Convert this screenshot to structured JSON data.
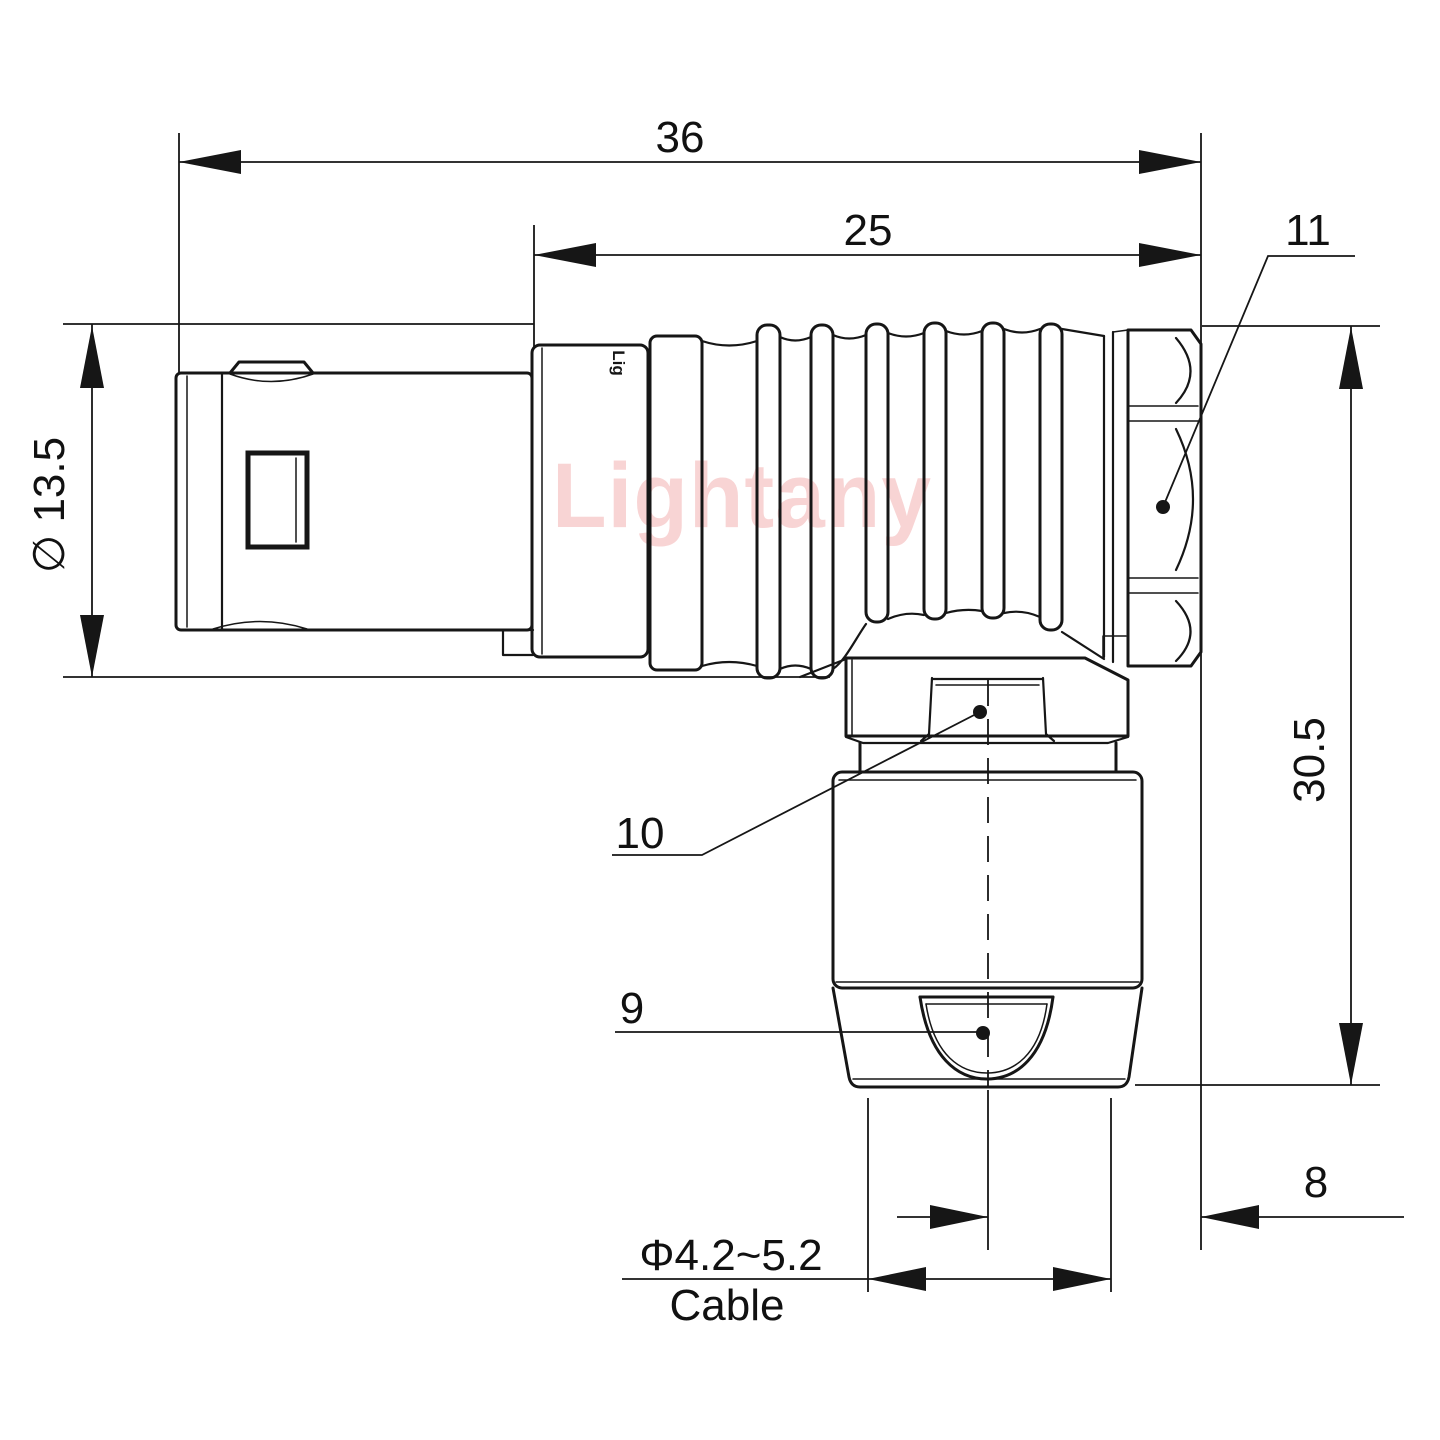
{
  "watermark": {
    "text": "Lightany"
  },
  "part_marking": "Lig",
  "dims": {
    "overall_length": "36",
    "front_length": "25",
    "nut_ref": "11",
    "shell_diameter": "∅ 13.5",
    "height": "30.5",
    "hex_ref": "10",
    "gland_ref": "9",
    "offset": "8",
    "cable_range": "Φ4.2~5.2",
    "cable_word": "Cable"
  }
}
